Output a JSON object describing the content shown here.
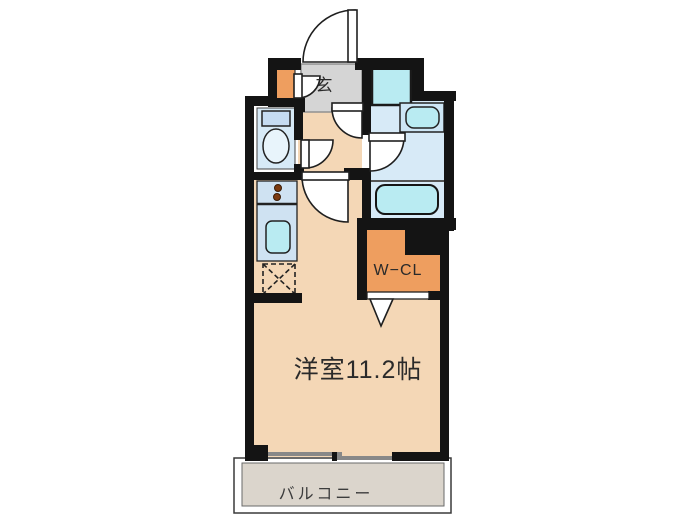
{
  "floorplan": {
    "labels": {
      "entrance": "玄",
      "walk_in_closet": "W−CL",
      "main_room": "洋室11.2帖",
      "balcony": "バルコニー"
    },
    "colors": {
      "wall": "#141414",
      "floor_main": "#f4d7b6",
      "floor_entrance": "#d5d5d5",
      "floor_wet": "#d7eaf7",
      "counter": "#cfe2f2",
      "accent_orange": "#ee9e5f",
      "fixture_cyan": "#b9ebf2",
      "toilet_tank": "#c6dcf2",
      "toilet_bowl": "#e8f4fb",
      "basin_unit": "#cde6f5",
      "balcony_floor": "#dbd5cc",
      "door_fill": "#ffffff",
      "window_glass": "#888888"
    },
    "fixtures": {
      "entrance_door": "hinged-door-arc",
      "shoe_cabinet_door": "hinged-door-arc",
      "hall_door": "hinged-door-arc",
      "toilet_door": "hinged-door-arc",
      "washroom_door": "hinged-door-arc",
      "closet_door": "folding-door-triangle",
      "window": "sliding-window",
      "appliances": [
        "toilet",
        "kitchen-stove-2-burner",
        "kitchen-sink",
        "refrigerator-space",
        "washing-machine-space",
        "wash-basin",
        "bathtub"
      ]
    }
  }
}
